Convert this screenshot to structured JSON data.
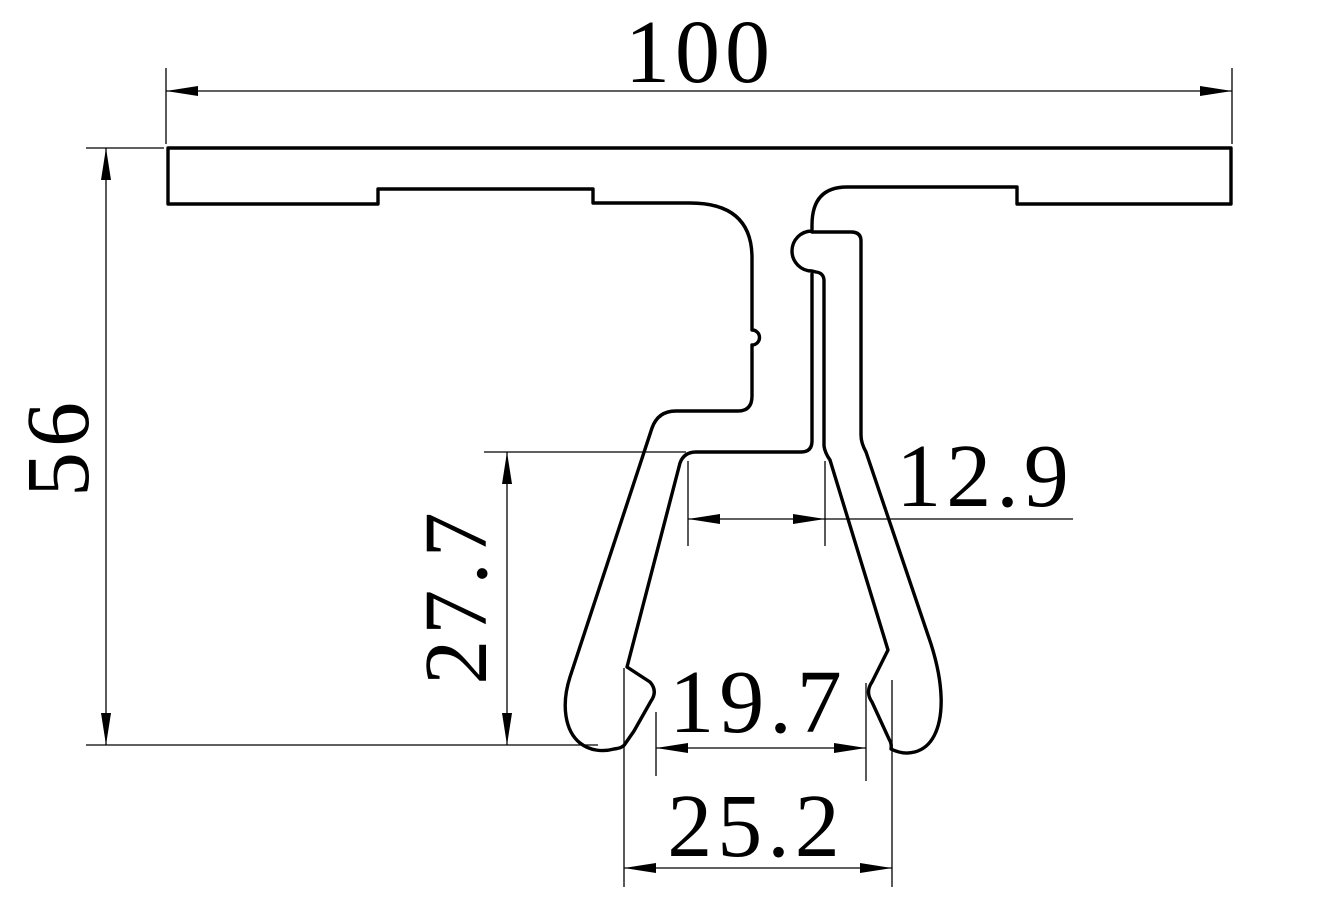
{
  "drawing": {
    "kind": "extrusion-profile-cross-section",
    "background_color": "#ffffff",
    "line_color": "#000000",
    "dims": {
      "overall_width": "100",
      "overall_height": "56",
      "leg_height": "27.7",
      "mouth_width": "12.9",
      "feet_inner_width": "19.7",
      "feet_outer_width": "25.2"
    }
  }
}
